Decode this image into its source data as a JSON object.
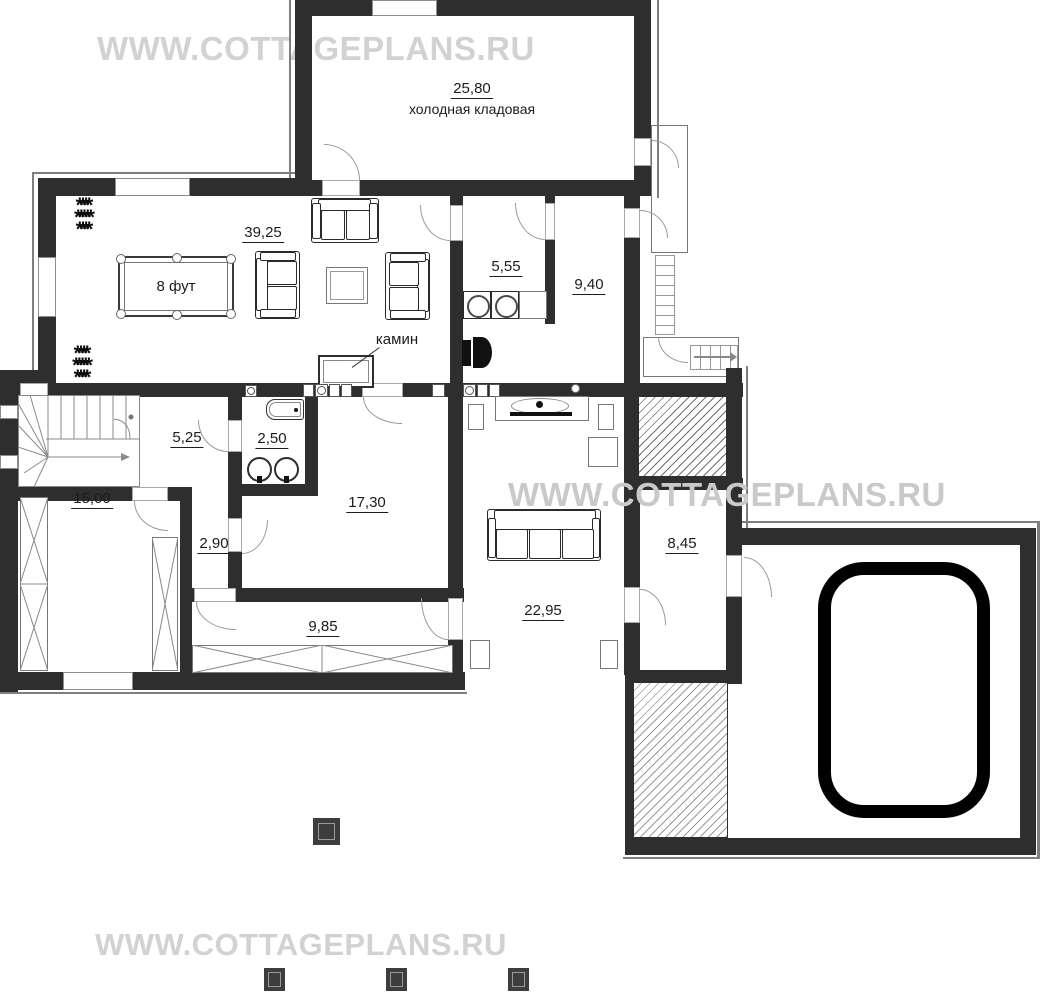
{
  "watermark": {
    "text": "WWW.COTTAGEPLANS.RU"
  },
  "rooms": [
    {
      "id": "cold-storage",
      "area": "25,80",
      "name": "холодная кладовая"
    },
    {
      "id": "billiard-room",
      "area": "39,25"
    },
    {
      "id": "laundry",
      "area": "5,55"
    },
    {
      "id": "hall-right",
      "area": "9,40"
    },
    {
      "id": "hall-left",
      "area": "5,25"
    },
    {
      "id": "bathroom",
      "area": "2,50"
    },
    {
      "id": "lounge",
      "area": "17,30"
    },
    {
      "id": "small-corridor",
      "area": "2,90"
    },
    {
      "id": "storage-room",
      "area": "15,00"
    },
    {
      "id": "corridor",
      "area": "9,85"
    },
    {
      "id": "cinema-room",
      "area": "22,95"
    },
    {
      "id": "sauna-hall",
      "area": "8,45"
    }
  ],
  "labels": {
    "pool_table": "8 фут",
    "fireplace": "камин"
  },
  "colors": {
    "wall": "#2e2e2e",
    "watermark": "#d2d2d2",
    "pool_border": "#000000"
  }
}
